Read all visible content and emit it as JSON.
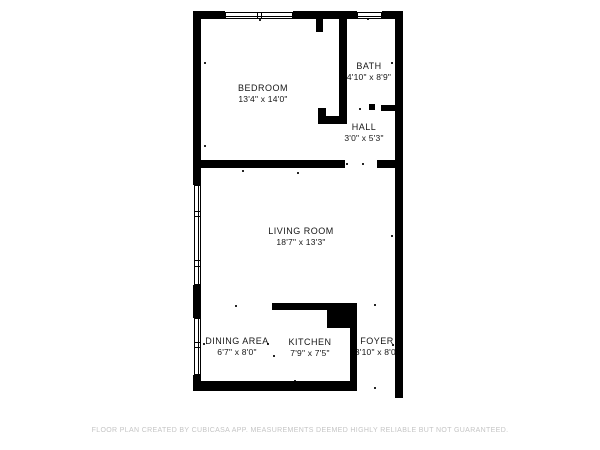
{
  "colors": {
    "wall": "#000000",
    "label": "#161616",
    "footer": "#c5c5c5",
    "background": "#ffffff"
  },
  "footer": {
    "text": "FLOOR PLAN CREATED BY CUBICASA APP. MEASUREMENTS DEEMED HIGHLY RELIABLE BUT NOT GUARANTEED."
  },
  "floorplan": {
    "rooms": [
      {
        "id": "bedroom",
        "name": "BEDROOM",
        "dimensions": "13'4\" x 14'0\"",
        "cx": 263,
        "cy": 94
      },
      {
        "id": "bath",
        "name": "BATH",
        "dimensions": "4'10\" x 8'9\"",
        "cx": 369,
        "cy": 72
      },
      {
        "id": "hall",
        "name": "HALL",
        "dimensions": "3'0\" x 5'3\"",
        "cx": 364,
        "cy": 133
      },
      {
        "id": "living-room",
        "name": "LIVING ROOM",
        "dimensions": "18'7\" x 13'3\"",
        "cx": 301,
        "cy": 237
      },
      {
        "id": "dining-area",
        "name": "DINING AREA",
        "dimensions": "6'7\" x 8'0\"",
        "cx": 237,
        "cy": 347
      },
      {
        "id": "kitchen",
        "name": "KITCHEN",
        "dimensions": "7'9\" x 7'5\"",
        "cx": 310,
        "cy": 348
      },
      {
        "id": "foyer",
        "name": "FOYER",
        "dimensions": "3'10\" x 8'0\"",
        "cx": 377,
        "cy": 347
      }
    ],
    "walls": [
      {
        "x": 193,
        "y": 11,
        "w": 32,
        "h": 8
      },
      {
        "x": 293,
        "y": 11,
        "w": 64,
        "h": 8
      },
      {
        "x": 382,
        "y": 11,
        "w": 21,
        "h": 8
      },
      {
        "x": 193,
        "y": 11,
        "w": 8,
        "h": 174
      },
      {
        "x": 193,
        "y": 285,
        "w": 8,
        "h": 33
      },
      {
        "x": 193,
        "y": 375,
        "w": 8,
        "h": 16
      },
      {
        "x": 395,
        "y": 11,
        "w": 8,
        "h": 387
      },
      {
        "x": 193,
        "y": 381,
        "w": 164,
        "h": 10
      },
      {
        "x": 193,
        "y": 160,
        "w": 152,
        "h": 8
      },
      {
        "x": 377,
        "y": 160,
        "w": 26,
        "h": 8
      },
      {
        "x": 339,
        "y": 19,
        "w": 8,
        "h": 105
      },
      {
        "x": 318,
        "y": 116,
        "w": 29,
        "h": 8
      },
      {
        "x": 318,
        "y": 108,
        "w": 8,
        "h": 10
      },
      {
        "x": 316,
        "y": 19,
        "w": 7,
        "h": 13
      },
      {
        "x": 381,
        "y": 105,
        "w": 14,
        "h": 6
      },
      {
        "x": 369,
        "y": 104,
        "w": 6,
        "h": 6
      },
      {
        "x": 272,
        "y": 303,
        "w": 55,
        "h": 7
      },
      {
        "x": 327,
        "y": 303,
        "w": 30,
        "h": 25
      },
      {
        "x": 350,
        "y": 328,
        "w": 7,
        "h": 53
      }
    ],
    "windows": [
      {
        "x": 225,
        "y": 12,
        "w": 68,
        "h": 7,
        "orient": "h",
        "dividers": [
          0.47,
          0.53
        ]
      },
      {
        "x": 357,
        "y": 12,
        "w": 25,
        "h": 7,
        "orient": "h",
        "dividers": []
      },
      {
        "x": 194,
        "y": 185,
        "w": 7,
        "h": 100,
        "orient": "v",
        "dividers": [
          0.25,
          0.31,
          0.76,
          0.82
        ]
      },
      {
        "x": 194,
        "y": 318,
        "w": 7,
        "h": 57,
        "orient": "v",
        "dividers": [
          0.42,
          0.5
        ]
      }
    ],
    "ticks": [
      {
        "x": 204,
        "y": 62
      },
      {
        "x": 204,
        "y": 145
      },
      {
        "x": 391,
        "y": 62
      },
      {
        "x": 391,
        "y": 235
      },
      {
        "x": 242,
        "y": 170
      },
      {
        "x": 297,
        "y": 172
      },
      {
        "x": 259,
        "y": 19
      },
      {
        "x": 367,
        "y": 18
      },
      {
        "x": 359,
        "y": 108
      },
      {
        "x": 346,
        "y": 163
      },
      {
        "x": 362,
        "y": 163
      },
      {
        "x": 235,
        "y": 305
      },
      {
        "x": 297,
        "y": 304
      },
      {
        "x": 374,
        "y": 304
      },
      {
        "x": 203,
        "y": 343
      },
      {
        "x": 267,
        "y": 343
      },
      {
        "x": 273,
        "y": 355
      },
      {
        "x": 355,
        "y": 344
      },
      {
        "x": 392,
        "y": 344
      },
      {
        "x": 374,
        "y": 387
      },
      {
        "x": 237,
        "y": 383
      },
      {
        "x": 294,
        "y": 380
      }
    ]
  }
}
